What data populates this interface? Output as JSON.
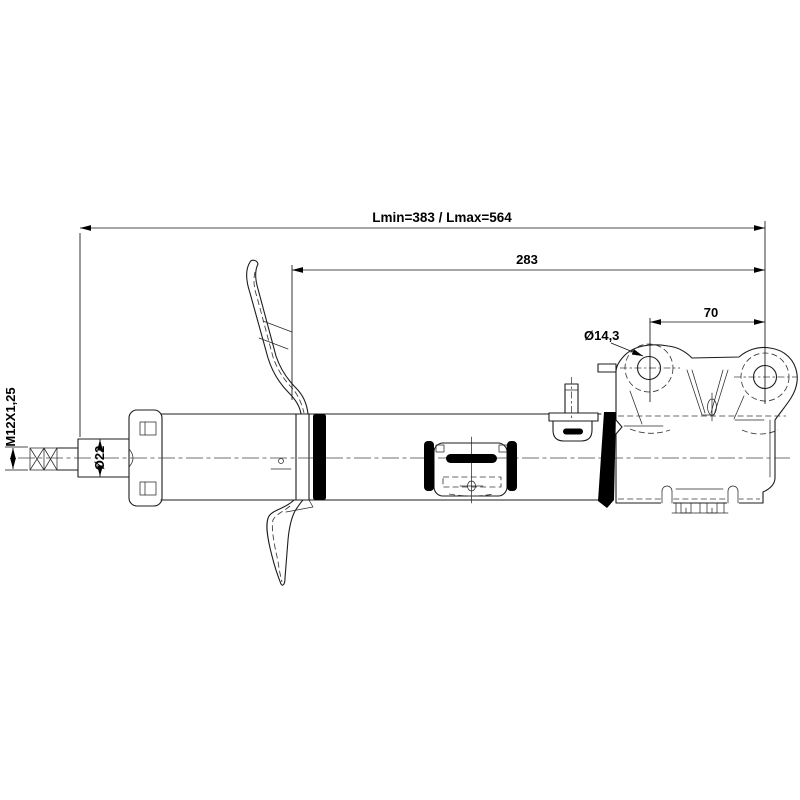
{
  "drawing": {
    "dimensions": {
      "overall_length": "Lmin=383 / Lmax=564",
      "upper_length": "283",
      "hole_spacing": "70",
      "hole_diameter": "Ø14,3",
      "thread_spec": "M12X1,25",
      "rod_diameter": "Ø22"
    },
    "colors": {
      "background": "#ffffff",
      "line": "#1c1c1c",
      "solid_fill": "#000000"
    }
  }
}
